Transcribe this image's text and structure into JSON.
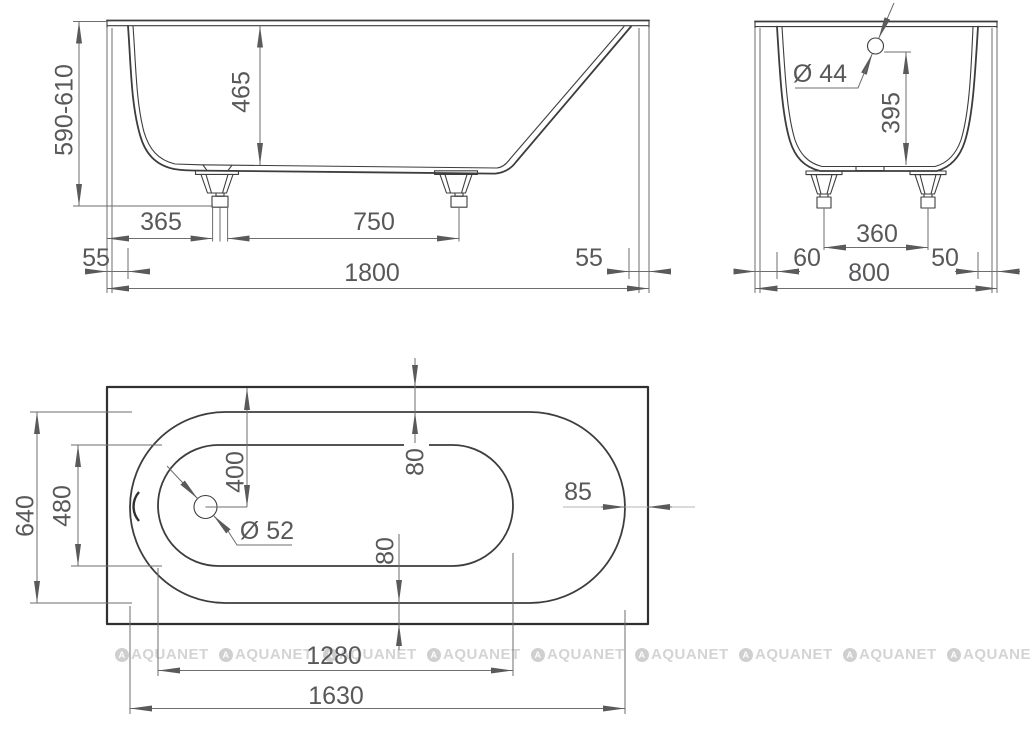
{
  "side_view": {
    "overall_height": "590-610",
    "inner_depth": "465",
    "drain_to_edge": "365",
    "feet_distance": "750",
    "rim_lip_left": "55",
    "length": "1800",
    "rim_lip_right": "55"
  },
  "end_view": {
    "overflow_diameter": "Ø 44",
    "overflow_height": "395",
    "feet_distance": "360",
    "gap_left": "60",
    "gap_right": "50",
    "width": "800"
  },
  "plan_view": {
    "outer_width": "640",
    "bottom_width": "480",
    "drain_offset": "400",
    "drain_diameter": "Ø 52",
    "rim_gap_top": "80",
    "rim_gap_bottom": "80",
    "rim_gap_right": "85",
    "bottom_length": "1280",
    "rim_length": "1630"
  },
  "watermark": {
    "logo_letter": "A",
    "text": "AQUANET",
    "count": 9
  },
  "colors": {
    "outline": "#3d3d3d",
    "dimension_line": "#6e6e6e",
    "dimension_text": "#58585a",
    "light_dimension_line": "#b5b5b5",
    "watermark": "#d4d4d4",
    "background": "#ffffff"
  }
}
